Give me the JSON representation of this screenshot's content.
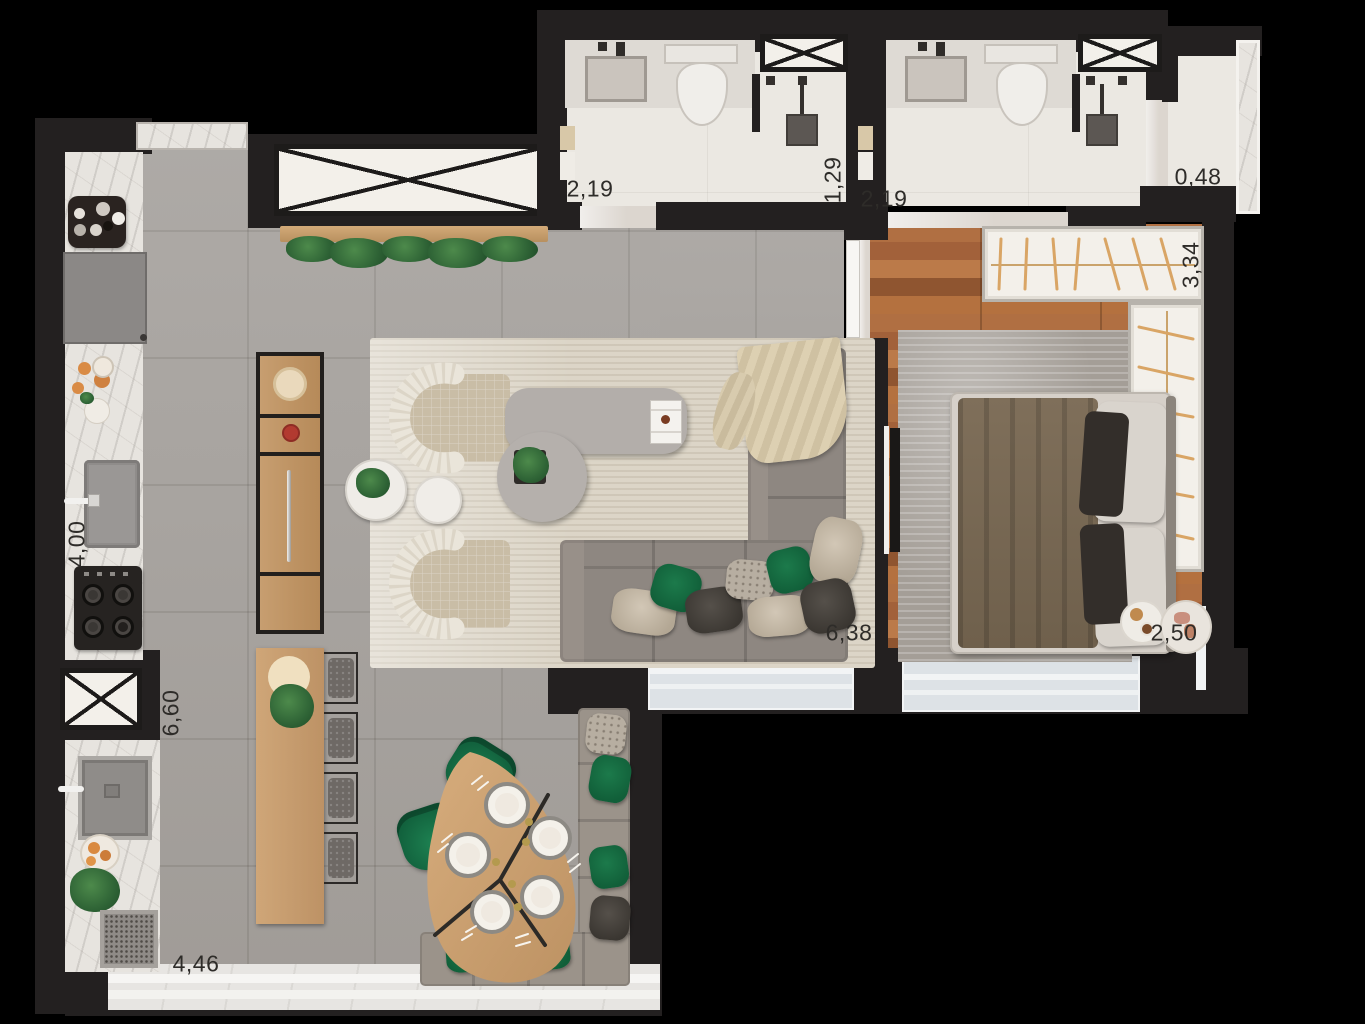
{
  "canvas": {
    "width": 1365,
    "height": 1024,
    "background": "#000000"
  },
  "labels": [
    {
      "id": "bath1-width",
      "text": "2,19"
    },
    {
      "id": "bath1-shower-width",
      "text": "1,29"
    },
    {
      "id": "bath2-width",
      "text": "2,19"
    },
    {
      "id": "side-niche-width",
      "text": "0,48"
    },
    {
      "id": "wardrobe-length",
      "text": "3,34"
    },
    {
      "id": "kitchen-length",
      "text": "4,00"
    },
    {
      "id": "living-length",
      "text": "6,60"
    },
    {
      "id": "living-width",
      "text": "6,38"
    },
    {
      "id": "bedroom-width",
      "text": "2,50"
    },
    {
      "id": "service-width",
      "text": "4,46"
    }
  ],
  "palette": {
    "background": "#000000",
    "walls": "#232020",
    "floor_tile_gray": "#a9a5a1",
    "floor_bathroom_cream": "#ebe8e2",
    "floor_wood": "#a9663c",
    "marble_counter": "#e7e4df",
    "rug_living": "#dcd5c7",
    "rug_bedroom": "#a49e97",
    "sofa_gray": "#8e8781",
    "pillow_green": "#177044",
    "wood_furniture": "#c49a6c",
    "duvet_brown": "#77684f",
    "wardrobe_white": "#f3f0ea",
    "hanger_accent": "#d9a565",
    "window_glass": "#dde2e6",
    "dimension_text": "#2e2c29"
  },
  "furniture": {
    "kitchen": [
      "coffee-station-tray",
      "built-in-appliance",
      "kitchen-sink",
      "stove-4-burner",
      "ventilation-shaft-x",
      "laundry-sink",
      "fruit-bowl",
      "laundry-plant",
      "grill-appliance"
    ],
    "living": [
      "plant-shelf",
      "ventilation-shaft-x",
      "sideboard",
      "kitchen-island",
      "bar-stools",
      "armchair",
      "armchair",
      "round-side-tables",
      "coffee-table",
      "round-coffee-table",
      "planter",
      "l-shaped-sofa",
      "throw-blanket",
      "area-rug"
    ],
    "dining": [
      "organic-dining-table",
      "plates",
      "green-chairs",
      "corner-bench",
      "bench-pillows"
    ],
    "bedroom": [
      "wardrobe-l-shaped",
      "double-bed",
      "pillows",
      "tv-panel",
      "area-rug",
      "breakfast-trays",
      "window"
    ],
    "bathrooms": [
      "vanity-sink",
      "toilet",
      "shower-head",
      "ventilation-shaft-x",
      "towel-rail"
    ]
  }
}
